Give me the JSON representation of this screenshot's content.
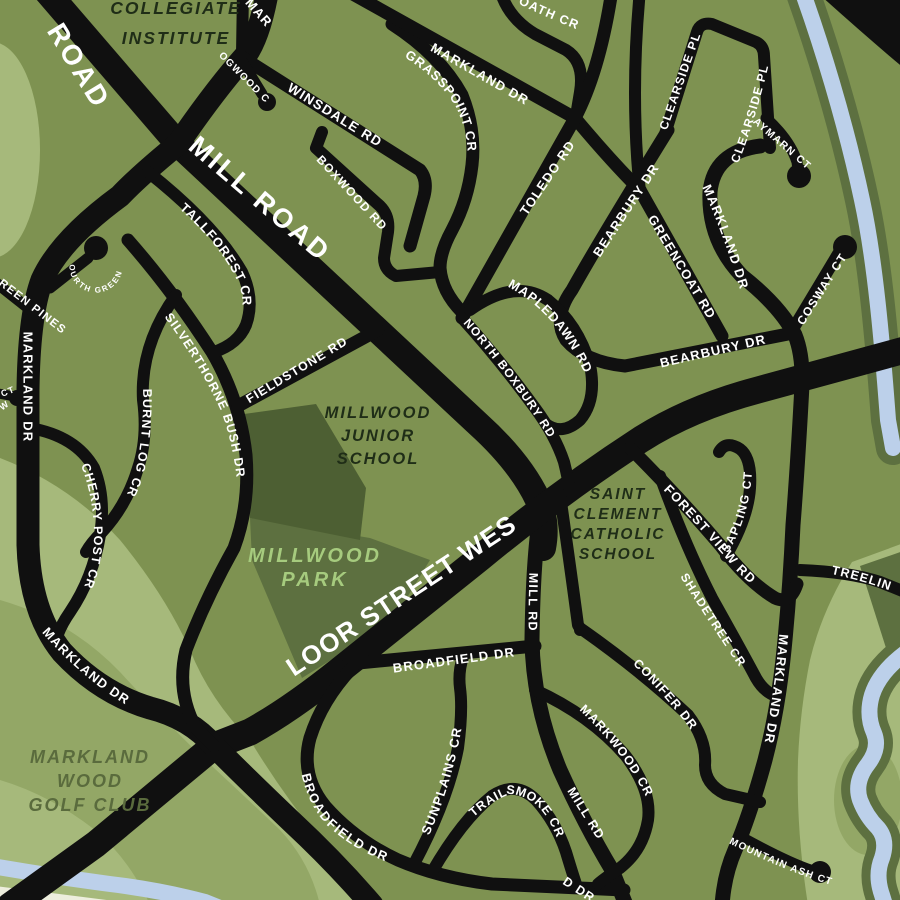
{
  "colors": {
    "background": "#7e9251",
    "road": "#101010",
    "road_label": "#ffffff",
    "park_dark": "#4d5f33",
    "park_medium": "#5d7040",
    "light_green": "#a6b97b",
    "golf_medium": "#93a766",
    "water": "#bcd0ea",
    "pale_corner": "#edeedd",
    "park_label": "#a6cb7e",
    "dark_label": "#1f2d17",
    "golf_label": "#5a6b3d"
  },
  "roads": {
    "road_partial": "ROAD",
    "mill_road": "MILL ROAD",
    "bloor": "BLOOR STREET WEST",
    "mar_partial": "MAR",
    "logwood": "LOGWOOD CT",
    "winsdale": "WINSDALE RD",
    "boxwood": "BOXWOOD RD",
    "grasspoint": "GRASSPOINT CR",
    "oath_partial": "OATH CR",
    "markland_top": "MARKLAND DR",
    "toledo": "TOLEDO RD",
    "clearside_left": "CLEARSIDE PL",
    "clearside_right": "CLEARSIDE PL",
    "aymarn": "AYMARN CT",
    "bearbury_upper": "BEARBURY DR",
    "greencoat": "GREENCOAT RD",
    "markland_right_top": "MARKLAND DR",
    "bearbury_lower": "BEARBURY DR",
    "cosway": "COSWAY CT",
    "mapledawn": "MAPLEDAWN RD",
    "north_boxbury": "NORTH BOXBURY RD",
    "tallforest": "TALLFOREST CR",
    "silverthorne": "SILVERTHORNE BUSH DR",
    "fieldstone": "FIELDSTONE RD",
    "burnt_log": "BURNT LOG CR",
    "cherry_post": "CHERRY POST CR",
    "markland_left": "MARKLAND DR",
    "markland_left_bottom": "MARKLAND DR",
    "green_pines_partial": "REEN PINES",
    "fourth_green": "FOURTH GREEN PL",
    "ct_fragment": "CT",
    "w_fragment": "W",
    "mill_rd_upper": "MILL RD",
    "mill_rd_lower": "MILL RD",
    "broadfield_upper": "BROADFIELD DR",
    "broadfield_lower": "BROADFIELD DR",
    "broadfield_partial": "D DR",
    "sunplains": "SUNPLAINS CR",
    "trailsmoke": "TRAILSMOKE CR",
    "conifer": "CONIFER DR",
    "markwood": "MARKWOOD CR",
    "mountain_ash": "MOUNTAIN ASH CT",
    "markland_right_bottom": "MARKLAND DR",
    "forest_view": "FOREST VIEW RD",
    "sapling": "SAPLING CT",
    "shadetree": "SHADETREE CR",
    "treeline_partial": "TREELIN"
  },
  "places": {
    "collegiate_l1": "COLLEGIATE",
    "collegiate_l2": "INSTITUTE",
    "millwood_school_l1": "MILLWOOD",
    "millwood_school_l2": "JUNIOR",
    "millwood_school_l3": "SCHOOL",
    "millwood_park_l1": "MILLWOOD",
    "millwood_park_l2": "PARK",
    "saint_clement_l1": "SAINT",
    "saint_clement_l2": "CLEMENT",
    "saint_clement_l3": "CATHOLIC",
    "saint_clement_l4": "SCHOOL",
    "golf_l1": "MARKLAND",
    "golf_l2": "WOOD",
    "golf_l3": "GOLF CLUB"
  }
}
